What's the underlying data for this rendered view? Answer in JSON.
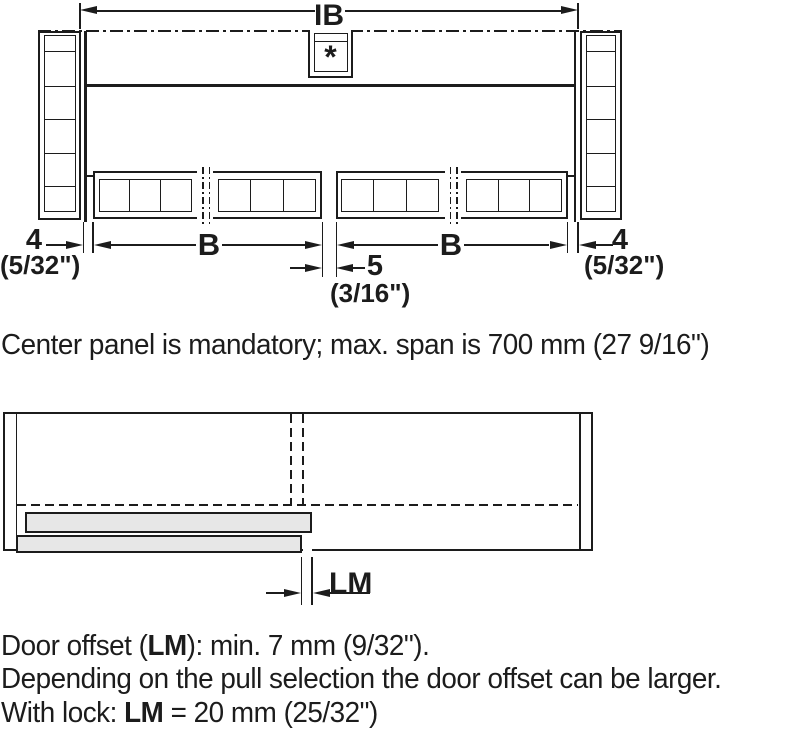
{
  "colors": {
    "ink": "#1c1c1c",
    "panel_fill": "#e7e7e7"
  },
  "top_diagram": {
    "inside_width_dim": "IB",
    "center_panel_marker": "*",
    "left_reveal_mm": "4",
    "left_reveal_in": "(5/32\")",
    "door_width_left": "B",
    "door_width_right": "B",
    "center_gap_mm": "5",
    "center_gap_in": "(3/16\")",
    "right_reveal_mm": "4",
    "right_reveal_in": "(5/32\")"
  },
  "center_note": "Center panel is mandatory; max. span is 700 mm (27 9/16\")",
  "bottom_diagram": {
    "door_offset_dim": "LM"
  },
  "bottom_notes": {
    "l1a": "Door offset (",
    "l1b": "LM",
    "l1c": "): min. 7 mm (9/32\").",
    "l2": "Depending on the pull selection the door offset can be larger.",
    "l3a": "With lock: ",
    "l3b": "LM",
    "l3c": " = 20 mm (25/32\")"
  }
}
